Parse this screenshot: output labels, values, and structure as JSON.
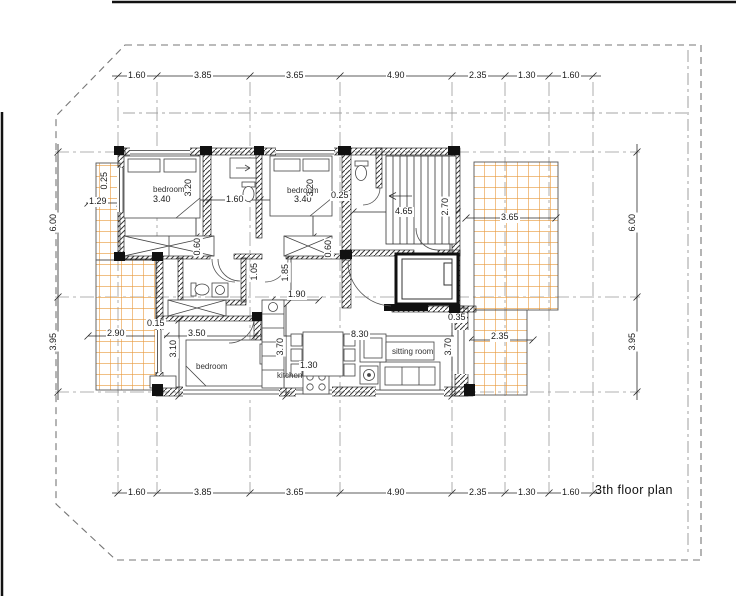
{
  "title": "3th floor plan",
  "dims": {
    "top": [
      "1.60",
      "3.85",
      "3.65",
      "4.90",
      "2.35",
      "1.30",
      "1.60"
    ],
    "bottom": [
      "1.60",
      "3.85",
      "3.65",
      "4.90",
      "2.35",
      "1.30",
      "1.60"
    ],
    "left": [
      "6.00",
      "3.95"
    ],
    "right": [
      "6.00",
      "3.95"
    ],
    "interior": {
      "bedroom1_width": "3.40",
      "bedroom1_depth": "3.20",
      "bathroom_width": "1.60",
      "bedroom2_width": "3.40",
      "bedroom2_depth": "3.20",
      "wall_bedroom2": "0.25",
      "stairs_length": "4.65",
      "balcony_right_width": "3.65",
      "stair_hall_depth": "2.70",
      "balcony_left_width": "1.29",
      "wall_top_left": "0.25",
      "door_left": "0.60",
      "door_right": "0.60",
      "closet_depth": "1.05",
      "hall_depth": "1.85",
      "hall_width": "1.90",
      "balcony_left_lower_width": "2.90",
      "wall_bottom_left": "0.15",
      "bedroom3_width": "3.50",
      "bedroom3_depth": "3.10",
      "kitchen_depth": "3.70",
      "kitchen_width": "1.30",
      "living_total_width": "8.30",
      "sitting_depth": "3.70",
      "wall_bottom_right": "0.35",
      "balcony_bottom_right_width": "2.35"
    }
  },
  "rooms": {
    "bedroom1": "bedroom",
    "bedroom2": "bedroom",
    "bedroom3": "bedroom",
    "kitchen": "kitchen",
    "sitting_room": "sitting room"
  },
  "colors": {
    "balcony_grid": "#E8993C",
    "walls": "#1c1c1c",
    "dimension_lines": "#2a2a2a",
    "boundary_dashed": "#777777"
  }
}
